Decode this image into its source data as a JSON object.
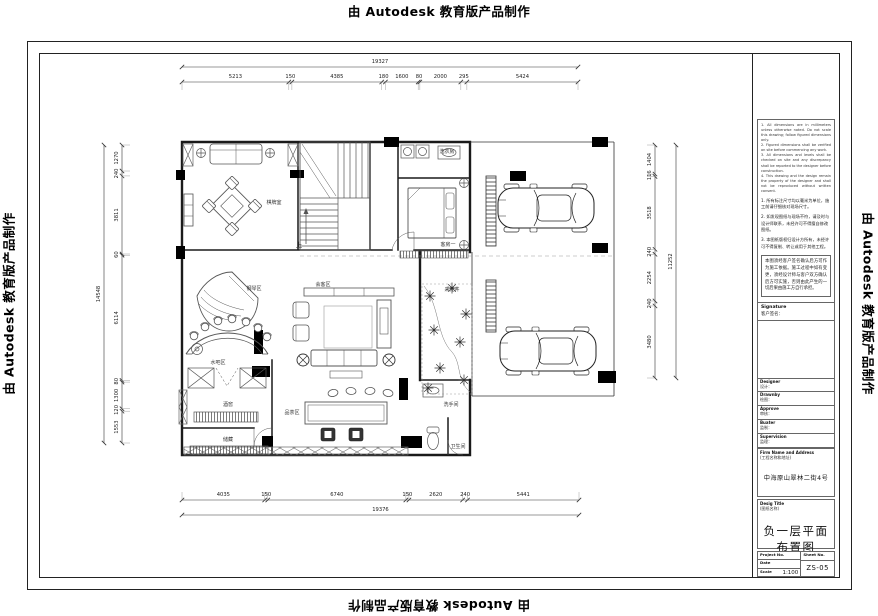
{
  "watermark": "由 Autodesk 教育版产品制作",
  "plan": {
    "rooms": [
      {
        "id": "qipai",
        "label": "棋牌室"
      },
      {
        "id": "xiyifang",
        "label": "洗衣房"
      },
      {
        "id": "kefang",
        "label": "客房一"
      },
      {
        "id": "huike",
        "label": "会客区"
      },
      {
        "id": "caiguang",
        "label": "采光井"
      },
      {
        "id": "gangqin",
        "label": "钢琴区"
      },
      {
        "id": "shuiba",
        "label": "水吧区"
      },
      {
        "id": "jiujiao",
        "label": "酒窖"
      },
      {
        "id": "chucang",
        "label": "储藏"
      },
      {
        "id": "pincha",
        "label": "品茶区"
      },
      {
        "id": "xishoujian",
        "label": "洗手间"
      },
      {
        "id": "weishengjian",
        "label": "卫生间"
      },
      {
        "id": "up",
        "label": "上"
      }
    ]
  },
  "dims": {
    "top": {
      "total": 19327,
      "segments": [
        5213,
        150,
        4385,
        180,
        1600,
        80,
        2000,
        295,
        5424
      ]
    },
    "bottom": {
      "total": 19376,
      "segments": [
        4035,
        150,
        6740,
        150,
        2620,
        240,
        5441
      ]
    },
    "left": {
      "total": 14548,
      "segments": [
        1270,
        240,
        3811,
        60,
        6114,
        80,
        1300,
        120,
        1553
      ]
    },
    "right": {
      "total": 11252,
      "segments": [
        1404,
        116,
        3518,
        240,
        2254,
        240,
        3480
      ]
    }
  },
  "titleblock": {
    "notes_en": [
      "1. All dimensions are in millimeters unless otherwise noted. Do not scale this drawing; follow figured dimensions only.",
      "2. Figured dimensions shall be verified on site before commencing any work.",
      "3. All dimensions and levels shall be checked on site and any discrepancy shall be reported to the designer before construction.",
      "4. This drawing and the design remain the property of the designer and shall not be reproduced without written consent."
    ],
    "notes_cn": [
      "1. 所有标注尺寸均以毫米为单位，施工前请仔细核对现场尺寸。",
      "2. 如发现图纸与现场不符，请及时与设计师联系，未经许可不得擅自修改图纸。",
      "3. 本图纸版权归设计方所有，未经许可不得复制、转让或用于其他工程。"
    ],
    "confirm_paragraph": "本图须经客户签名确认后方可作为施工依据。施工过程中如有变更，须经设计师与客户双方确认后方可实施，否则由此产生的一切后果由施工方自行承担。",
    "signature_label": "Signature",
    "signature_cn": "客户签名：",
    "fields": [
      {
        "en": "Designer",
        "cn": "设计："
      },
      {
        "en": "Drawnby",
        "cn": "绘图："
      },
      {
        "en": "Approve",
        "cn": "审核："
      },
      {
        "en": "Buater",
        "cn": "监制："
      },
      {
        "en": "Supervision",
        "cn": "监理："
      }
    ],
    "firm_label": "Firm Name and Address",
    "firm_label_cn": "(工程名称和地址)",
    "firm_value": "中海原山翠林二街4号",
    "desig_label": "Desig Title",
    "desig_label_cn": "(图纸名称)",
    "desig_value": "负一层平面布置图",
    "project_label": "Project No.",
    "sheet_label": "Sheet No.",
    "date_label": "Date",
    "scale_label": "Scale",
    "scale_value": "1:100",
    "sheet_value": "ZS-05"
  }
}
